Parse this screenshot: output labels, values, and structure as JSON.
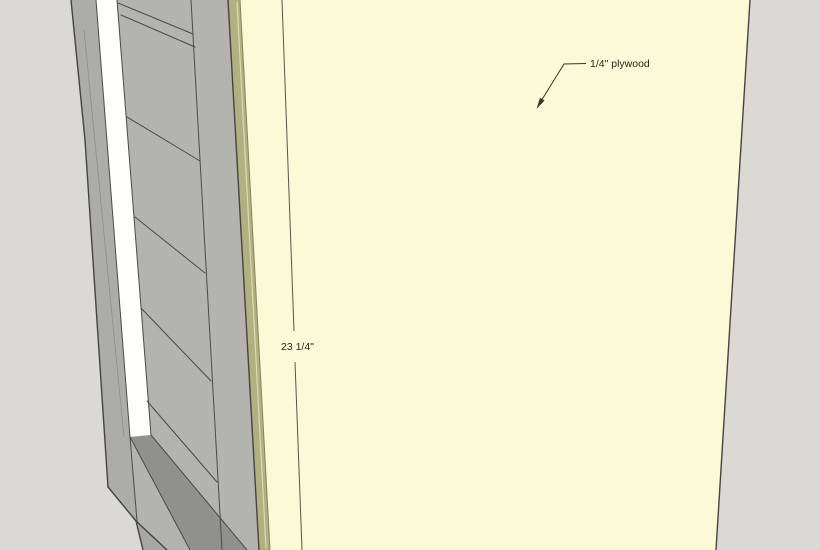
{
  "scene": {
    "description": "3D model view of cabinet carcass with quarter-inch plywood back panel",
    "annotations": {
      "plywood_label": "1/4\" plywood",
      "dimension_label": "23 1/4\""
    },
    "colors": {
      "background": "#DAD9D4",
      "plywood_face": "#FCFAD6",
      "plywood_edge": "#B1B083",
      "plywood_edge_highlight": "#DCDBAE",
      "plywood_edge_divider": "#84835D",
      "gray_face": "#B3B3B0",
      "gray_face_dark": "#ACACA9",
      "bottom_face": "#A7A7A3",
      "slot_white": "#FEFEFD",
      "recess_shadow": "#90908C",
      "edge_line": "#45443F",
      "inner_line": "#4A4A46",
      "subtle_line": "#8E8E89",
      "dim_line": "#55554E",
      "leader_line": "#35342F",
      "text": "#27261F"
    }
  }
}
